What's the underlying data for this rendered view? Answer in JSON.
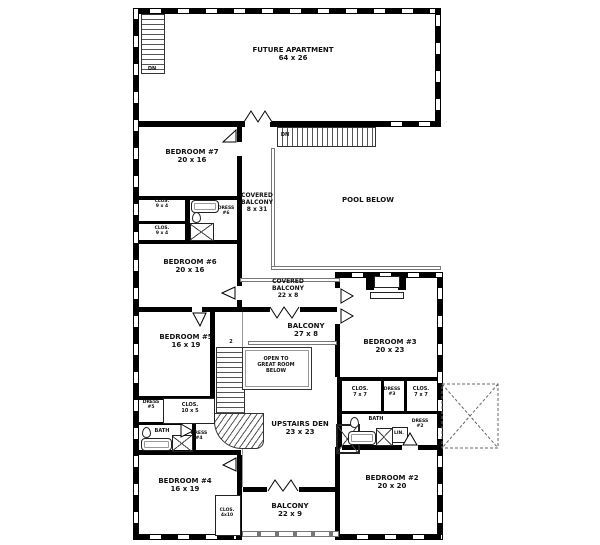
{
  "plan": {
    "apartment": {
      "name": "FUTURE APARTMENT",
      "size": "64 x 26"
    },
    "stairs": {
      "dn_upper": "DN",
      "dn_lower": "DN",
      "flight_number": "2"
    },
    "pool": {
      "name": "POOL BELOW"
    },
    "balconies": {
      "covered_tall": {
        "l1": "COVERED",
        "l2": "BALCONY",
        "size": "8 x 31"
      },
      "covered_wide": {
        "l1": "COVERED",
        "l2": "BALCONY",
        "size": "22 x 8"
      },
      "balcony_27": {
        "name": "BALCONY",
        "size": "27 x 8"
      },
      "balcony_22": {
        "name": "BALCONY",
        "size": "22 x 9"
      }
    },
    "center": {
      "open_below": {
        "l1": "OPEN TO",
        "l2": "GREAT ROOM",
        "l3": "BELOW"
      },
      "den": {
        "name": "UPSTAIRS DEN",
        "size": "23 x 23"
      }
    },
    "left_wing": {
      "bedroom7": {
        "name": "BEDROOM #7",
        "size": "20 x 16"
      },
      "closet_a": {
        "name": "CLOS.",
        "size": "9 x 4"
      },
      "closet_b": {
        "name": "CLOS.",
        "size": "9 x 4"
      },
      "dress6": {
        "l1": "DRESS",
        "l2": "#6"
      },
      "bedroom6": {
        "name": "BEDROOM #6",
        "size": "20 x 16"
      },
      "bedroom5": {
        "name": "BEDROOM #5",
        "size": "16 x 19"
      },
      "dress5": {
        "l1": "DRESS",
        "l2": "#5"
      },
      "closet_10x5": {
        "name": "CLOS.",
        "size": "10 x 5"
      },
      "bath": {
        "name": "BATH"
      },
      "dress4": {
        "l1": "DRESS",
        "l2": "#4"
      },
      "bedroom4": {
        "name": "BEDROOM #4",
        "size": "16 x 19"
      },
      "closet_4x10": {
        "name": "CLOS.",
        "size": "4x10"
      }
    },
    "right_wing": {
      "bedroom3": {
        "name": "BEDROOM #3",
        "size": "20 x 23"
      },
      "closet_a": {
        "name": "CLOS.",
        "size": "7 x 7"
      },
      "dress3": {
        "l1": "DRESS",
        "l2": "#3"
      },
      "closet_b": {
        "name": "CLOS.",
        "size": "7 x 7"
      },
      "bath": {
        "name": "BATH"
      },
      "dress2": {
        "l1": "DRESS",
        "l2": "#2"
      },
      "linen": {
        "name": "LIN."
      },
      "bedroom2": {
        "name": "BEDROOM #2",
        "size": "20 x 20"
      }
    },
    "colors": {
      "wall": "#000000",
      "line": "#555555",
      "text": "#111111",
      "background": "#ffffff"
    }
  }
}
